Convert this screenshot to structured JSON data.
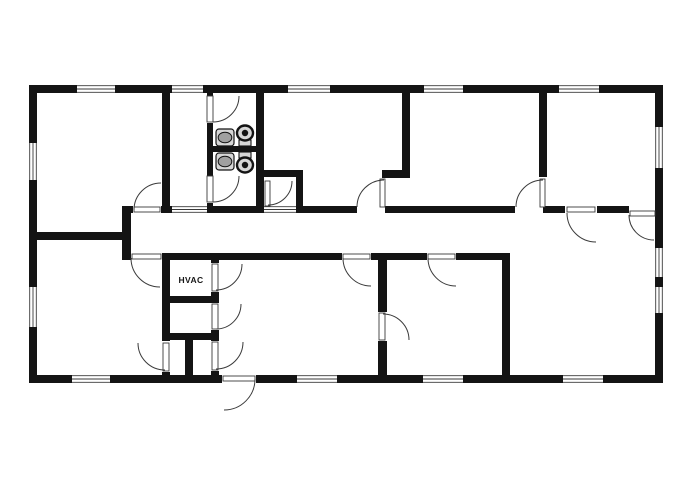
{
  "title": "building-floor-plan",
  "label": {
    "text": "HVAC",
    "x": 191,
    "y": 283
  },
  "colors": {
    "wall": "#141414",
    "line": "#3a3a3a",
    "bg": "#ffffff",
    "fixture": "#d7d7d7",
    "fixture_dark": "#a0a0a0"
  },
  "plan": {
    "walls": [
      [
        29,
        85,
        634,
        8
      ],
      [
        29,
        375,
        634,
        8
      ],
      [
        29,
        85,
        8,
        298
      ],
      [
        655,
        85,
        8,
        298
      ],
      [
        162,
        93,
        8,
        113
      ],
      [
        207,
        93,
        6,
        113
      ],
      [
        207,
        146,
        57,
        6
      ],
      [
        256,
        93,
        8,
        113
      ],
      [
        256,
        170,
        47,
        7
      ],
      [
        296,
        170,
        7,
        36
      ],
      [
        122,
        206,
        534,
        7
      ],
      [
        122,
        206,
        9,
        54
      ],
      [
        29,
        232,
        98,
        8
      ],
      [
        382,
        170,
        28,
        8
      ],
      [
        402,
        93,
        8,
        77
      ],
      [
        539,
        93,
        8,
        84
      ],
      [
        122,
        253,
        388,
        7
      ],
      [
        502,
        253,
        8,
        130
      ],
      [
        378,
        258,
        9,
        125
      ],
      [
        162,
        260,
        8,
        123
      ],
      [
        211,
        260,
        8,
        123
      ],
      [
        162,
        296,
        57,
        7
      ],
      [
        162,
        333,
        57,
        7
      ],
      [
        185,
        340,
        8,
        43
      ]
    ],
    "door_openings": [
      [
        133,
        206,
        28,
        7
      ],
      [
        357,
        206,
        28,
        7
      ],
      [
        515,
        206,
        28,
        7
      ],
      [
        565,
        206,
        32,
        7
      ],
      [
        629,
        206,
        26,
        7
      ],
      [
        131,
        253,
        31,
        7
      ],
      [
        342,
        253,
        29,
        7
      ],
      [
        427,
        253,
        29,
        7
      ],
      [
        378,
        312,
        9,
        29
      ],
      [
        162,
        341,
        8,
        31
      ],
      [
        211,
        263,
        8,
        29
      ],
      [
        211,
        303,
        8,
        27
      ],
      [
        211,
        341,
        8,
        30
      ],
      [
        207,
        96,
        6,
        27
      ],
      [
        207,
        176,
        6,
        27
      ],
      [
        222,
        375,
        34,
        8
      ]
    ],
    "windows": [
      [
        77,
        85,
        38,
        8,
        "h"
      ],
      [
        172,
        85,
        31,
        8,
        "h"
      ],
      [
        288,
        85,
        42,
        8,
        "h"
      ],
      [
        424,
        85,
        39,
        8,
        "h"
      ],
      [
        559,
        85,
        40,
        8,
        "h"
      ],
      [
        72,
        375,
        38,
        8,
        "h"
      ],
      [
        297,
        375,
        40,
        8,
        "h"
      ],
      [
        423,
        375,
        40,
        8,
        "h"
      ],
      [
        563,
        375,
        40,
        8,
        "h"
      ],
      [
        172,
        206,
        35,
        7,
        "h"
      ],
      [
        264,
        206,
        32,
        7,
        "h"
      ],
      [
        29,
        143,
        8,
        37,
        "v"
      ],
      [
        29,
        287,
        8,
        40,
        "v"
      ],
      [
        655,
        127,
        8,
        41,
        "v"
      ],
      [
        655,
        248,
        8,
        29,
        "v"
      ],
      [
        655,
        287,
        8,
        26,
        "v"
      ]
    ],
    "door_leaves": [
      [
        134,
        207,
        26,
        5
      ],
      [
        132,
        254,
        29,
        5
      ],
      [
        380,
        179,
        5,
        28
      ],
      [
        540,
        179,
        5,
        28
      ],
      [
        567,
        207,
        28,
        5
      ],
      [
        630,
        211,
        25,
        5
      ],
      [
        343,
        254,
        27,
        5
      ],
      [
        428,
        254,
        27,
        5
      ],
      [
        379,
        313,
        6,
        27
      ],
      [
        163,
        343,
        6,
        28
      ],
      [
        212,
        264,
        6,
        27
      ],
      [
        212,
        304,
        6,
        25
      ],
      [
        212,
        342,
        6,
        28
      ],
      [
        207,
        96,
        6,
        26
      ],
      [
        207,
        176,
        6,
        26
      ],
      [
        265,
        181,
        5,
        25
      ],
      [
        223,
        376,
        32,
        5
      ]
    ],
    "door_arcs": [
      [
        161,
        210,
        27,
        180,
        270
      ],
      [
        160,
        258,
        29,
        90,
        180
      ],
      [
        384,
        207,
        27,
        180,
        270
      ],
      [
        543,
        207,
        27,
        180,
        270
      ],
      [
        596,
        213,
        29,
        90,
        180
      ],
      [
        654,
        215,
        25,
        90,
        180
      ],
      [
        371,
        258,
        28,
        90,
        180
      ],
      [
        456,
        258,
        28,
        90,
        180
      ],
      [
        383,
        340,
        26,
        270,
        360
      ],
      [
        165,
        343,
        27,
        90,
        180
      ],
      [
        216,
        264,
        26,
        0,
        90
      ],
      [
        216,
        304,
        25,
        0,
        90
      ],
      [
        216,
        342,
        27,
        0,
        90
      ],
      [
        213,
        96,
        26,
        0,
        90
      ],
      [
        213,
        176,
        26,
        0,
        90
      ],
      [
        268,
        181,
        24,
        0,
        90
      ],
      [
        224,
        379,
        31,
        0,
        90
      ]
    ],
    "sinks": [
      [
        216,
        129,
        18,
        17
      ],
      [
        216,
        153,
        18,
        17
      ]
    ],
    "toilets": [
      {
        "tank": [
          239,
          140,
          12,
          6
        ],
        "bowl": [
          245,
          133,
          8,
          7.5
        ]
      },
      {
        "tank": [
          239,
          152,
          12,
          6
        ],
        "bowl": [
          245,
          165,
          8,
          7.5
        ]
      }
    ]
  }
}
